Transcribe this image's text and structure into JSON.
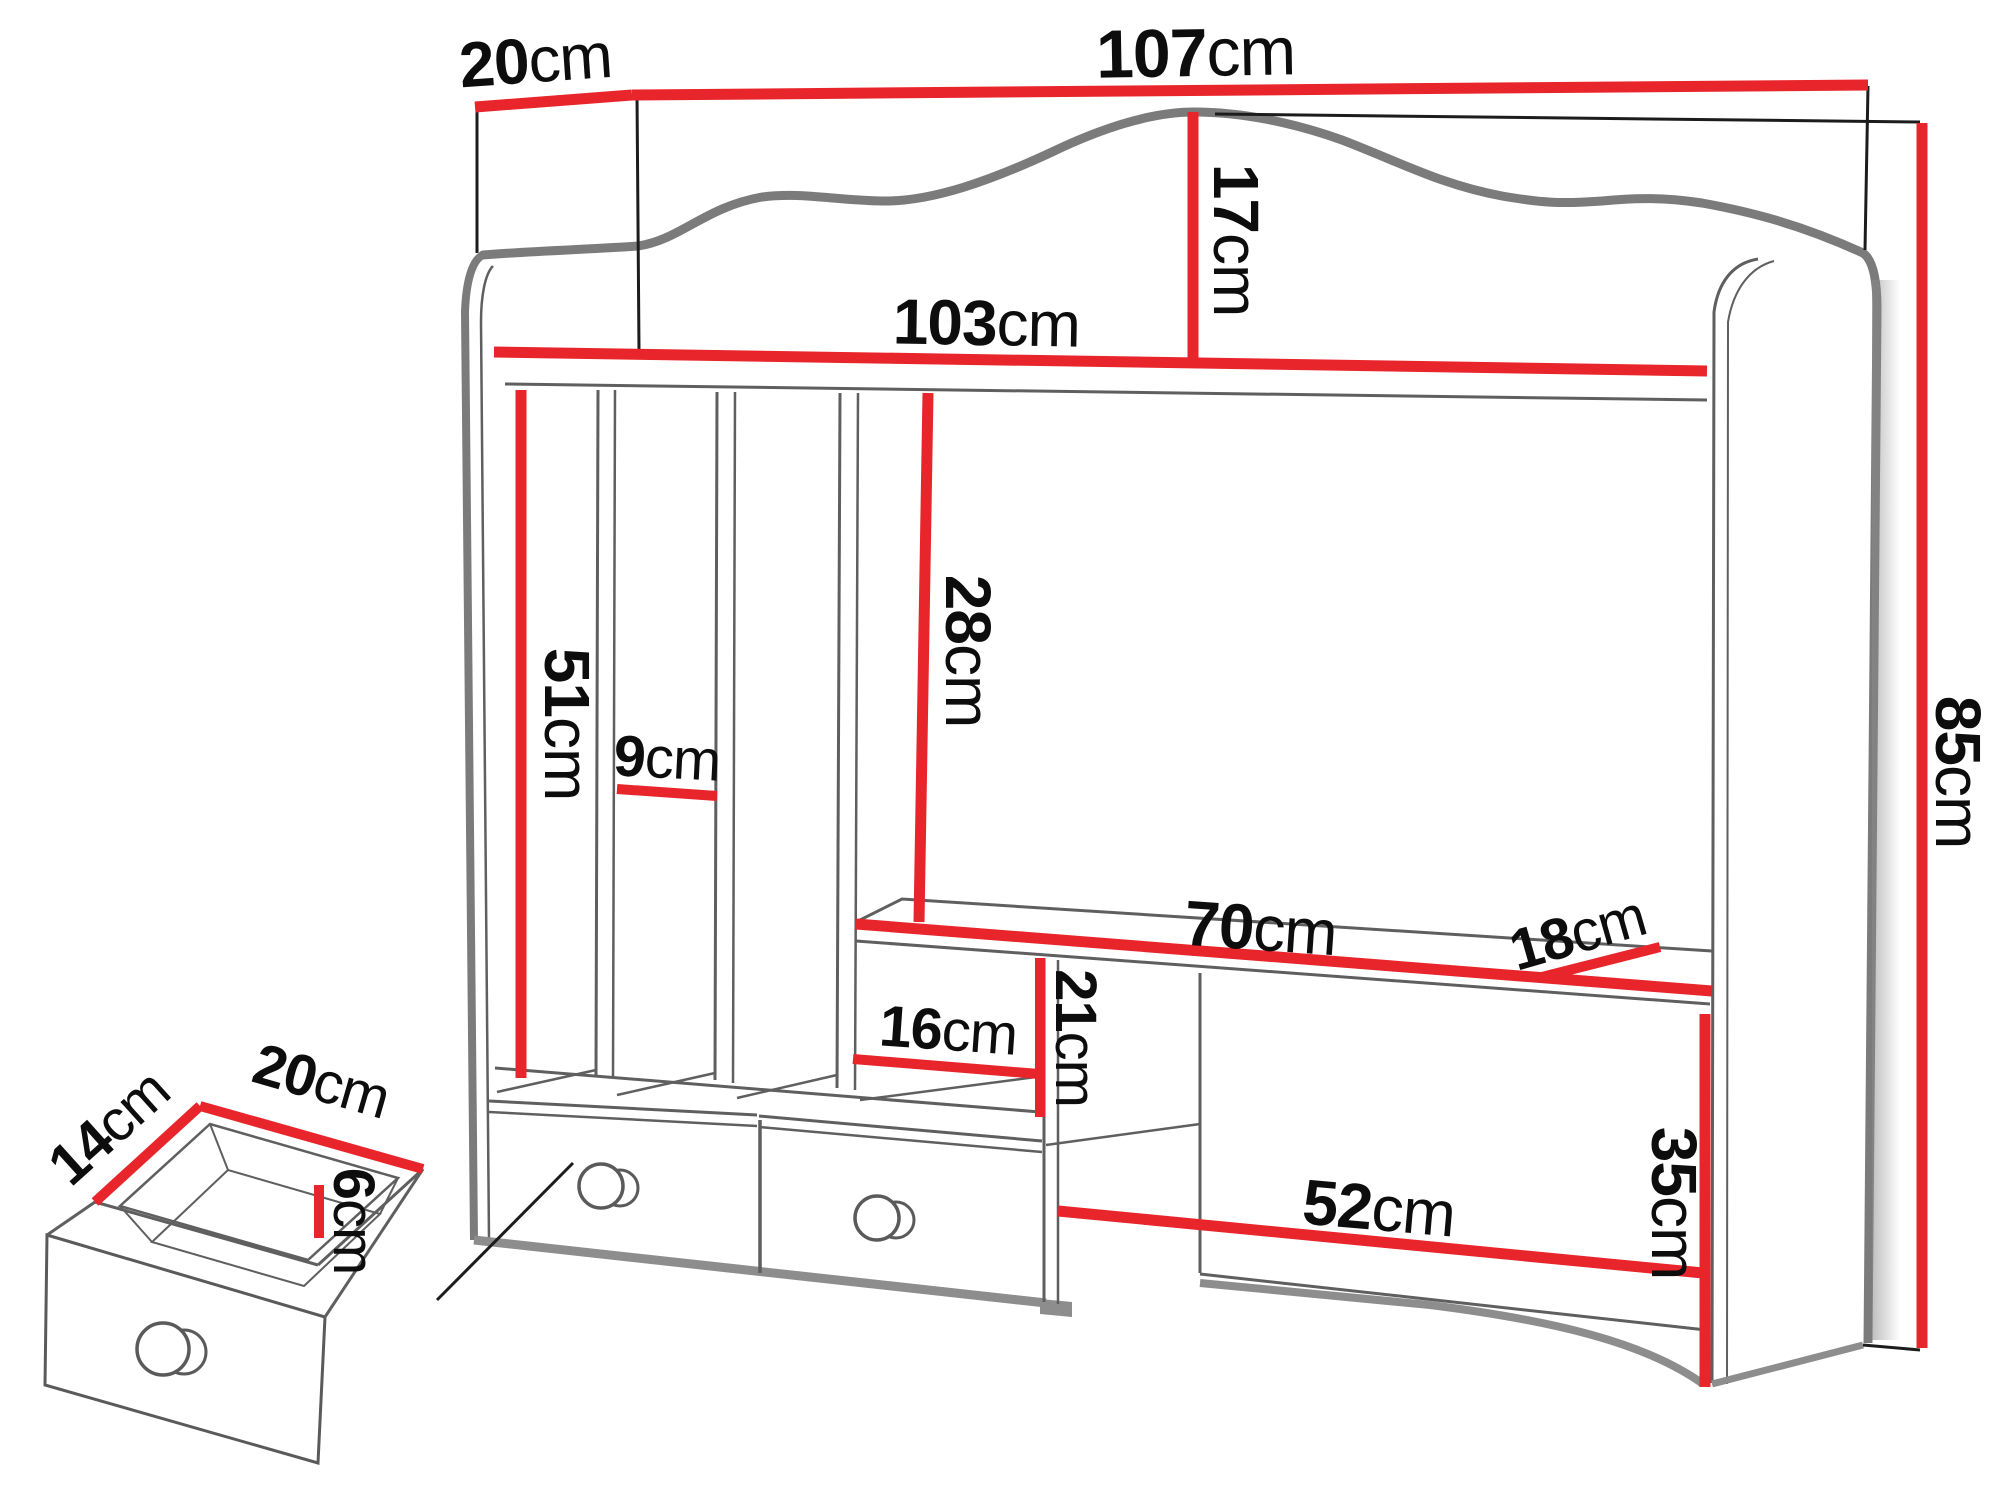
{
  "diagram": {
    "type": "furniture-dimension-drawing",
    "subject": "desk hutch organizer with book slots, two drawers and open desk niche, plus detached small drawer detail",
    "unit": "cm",
    "colors": {
      "dimension_line": "#e8252b",
      "outline_gray": "#7b7b7b",
      "thin_line": "#5f5f5f",
      "text": "#0d0d0d",
      "background": "#ffffff"
    },
    "main_unit": {
      "dims": {
        "top_depth": {
          "num": "20",
          "unit": "cm"
        },
        "top_width": {
          "num": "107",
          "unit": "cm"
        },
        "shelf_width": {
          "num": "103",
          "unit": "cm"
        },
        "crown_height": {
          "num": "17",
          "unit": "cm"
        },
        "side_height": {
          "num": "85",
          "unit": "cm"
        },
        "slot_height": {
          "num": "51",
          "unit": "cm"
        },
        "slot_width": {
          "num": "9",
          "unit": "cm"
        },
        "niche_height": {
          "num": "28",
          "unit": "cm"
        },
        "desk_width": {
          "num": "70",
          "unit": "cm"
        },
        "desk_depth": {
          "num": "18",
          "unit": "cm"
        },
        "cubby_width": {
          "num": "16",
          "unit": "cm"
        },
        "cubby_height": {
          "num": "21",
          "unit": "cm"
        },
        "opening_width": {
          "num": "52",
          "unit": "cm"
        },
        "opening_height": {
          "num": "35",
          "unit": "cm"
        }
      }
    },
    "drawer_detail": {
      "dims": {
        "depth": {
          "num": "14",
          "unit": "cm"
        },
        "width": {
          "num": "20",
          "unit": "cm"
        },
        "height": {
          "num": "6",
          "unit": "cm"
        }
      }
    }
  }
}
